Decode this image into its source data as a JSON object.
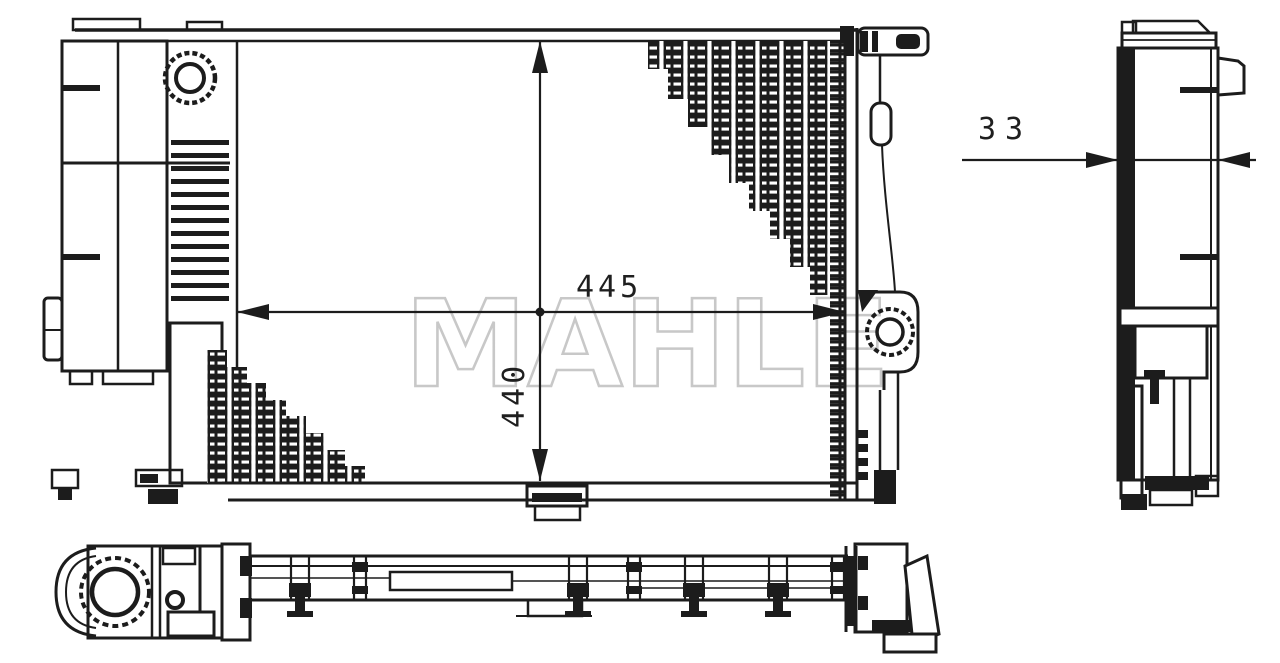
{
  "drawing": {
    "watermark_text": "MAHLE",
    "line_color": "#1c1c1c",
    "watermark_color": "#c8c8c8",
    "background_color": "#ffffff"
  },
  "dimension_labels": {
    "core_width": "445",
    "core_height": "440",
    "core_depth": "33"
  }
}
